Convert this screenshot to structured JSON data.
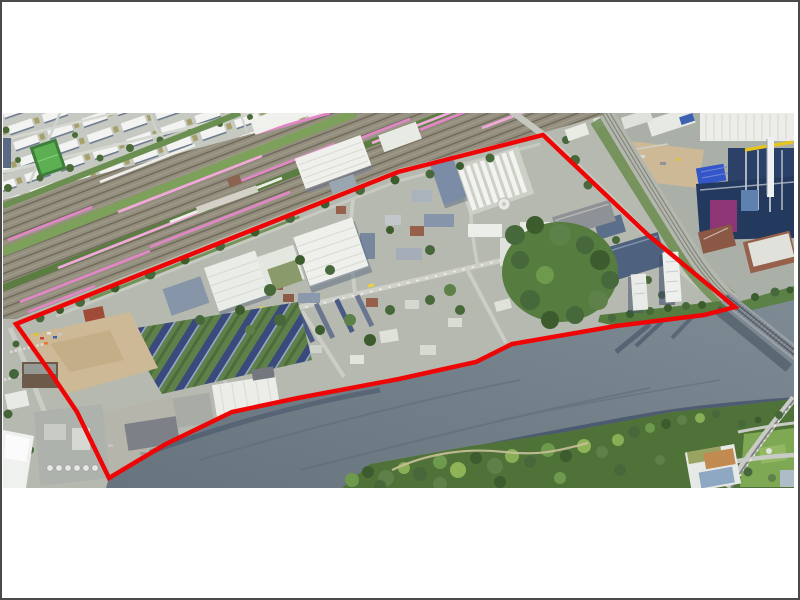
{
  "window": {
    "width": 800,
    "height": 600,
    "background": "#ffffff",
    "border_color": "#4a4a4a"
  },
  "photo": {
    "x": 3,
    "y": 113,
    "width": 791,
    "height": 375
  },
  "boundary": {
    "color": "#ee0606",
    "stroke_width": 4.5,
    "points": "16,324 398,172 543,135 648,235 735,307 704,315 616,326 512,344 476,362 399,379 298,398 232,412 166,444 109,478 77,412 50,372"
  },
  "palette": {
    "photo_base": "#b5b9af",
    "track_bed": "#938e7e",
    "track_line": "#6e6959",
    "train_pink": "#e287c6",
    "train_pink_light": "#f0a9d9",
    "grass": "#7da05a",
    "tree": "#47683a",
    "tree_dark": "#3c5c2d",
    "tree_light": "#6e9a4e",
    "building_white": "#eff0ec",
    "building_shadow": "#5a6980",
    "slab_blue": "#7b8da6",
    "brick": "#96604a",
    "sand": "#cdb995",
    "navy": "#2c4168",
    "magenta": "#8e3576",
    "yellow": "#e8c51c",
    "road": "#d0d1ca",
    "bridge": "#9aa0a7",
    "water": "#67747e",
    "water_light": "#7e8b94",
    "row_roof": "#3b4a7c"
  },
  "scene": {
    "kind": "aerial-photograph",
    "overlay": "red site-boundary outline polygon",
    "regions": [
      "residential-blocks-northwest",
      "railway-yard-with-pink-trains",
      "freight-sheds",
      "industrial-district-inside-boundary",
      "sewage-treatment-plant",
      "row-houses-with-dark-roofs",
      "vacant-sand-lot",
      "warehouses-on-quay",
      "river",
      "south-bank-park",
      "rail-bridge",
      "s-bahn-viaduct",
      "construction-site",
      "power-plant-east",
      "residential-towers-at-river",
      "road-junction-southeast"
    ]
  }
}
